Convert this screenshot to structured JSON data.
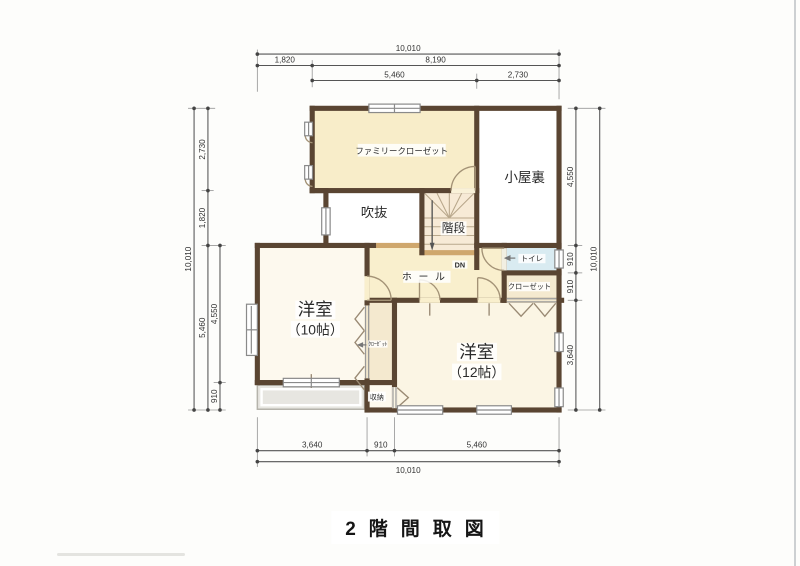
{
  "title": "2階間取図",
  "rooms": {
    "family_closet": "ファミリークローゼット",
    "attic": "小屋裏",
    "void": "吹抜",
    "stairs": "階段",
    "hall": "ホール",
    "dn": "DN",
    "toilet": "トイレ",
    "closet": "クローゼット",
    "closet_small": "ｸﾛｰｾﾞｯﾄ",
    "storage": "収納",
    "room10_name": "洋室",
    "room10_size": "（10帖）",
    "room12_name": "洋室",
    "room12_size": "（12帖）"
  },
  "dimensions": {
    "top": {
      "total": "10,010",
      "row2": [
        "1,820",
        "8,190"
      ],
      "row3": [
        "5,460",
        "2,730"
      ]
    },
    "left": {
      "total": "10,010",
      "col": [
        "2,730",
        "1,820",
        "5,460"
      ],
      "inner": [
        "4,550",
        "910"
      ]
    },
    "right": {
      "total": "10,010",
      "col": [
        "4,550",
        "910",
        "910",
        "3,640"
      ]
    },
    "bottom": {
      "row1": [
        "3,640",
        "910",
        "5,460"
      ],
      "total": "10,010"
    }
  },
  "colors": {
    "wall": "#5a4532",
    "half_wall": "#cfa76d",
    "room_cream": "#f8eecb",
    "room_pale": "#fbf5e4",
    "toilet_blue": "#d9ebf1",
    "closet_cream": "#f4e9cf",
    "roof_grey": "#e7e6e1",
    "dimension_line": "#555555"
  }
}
